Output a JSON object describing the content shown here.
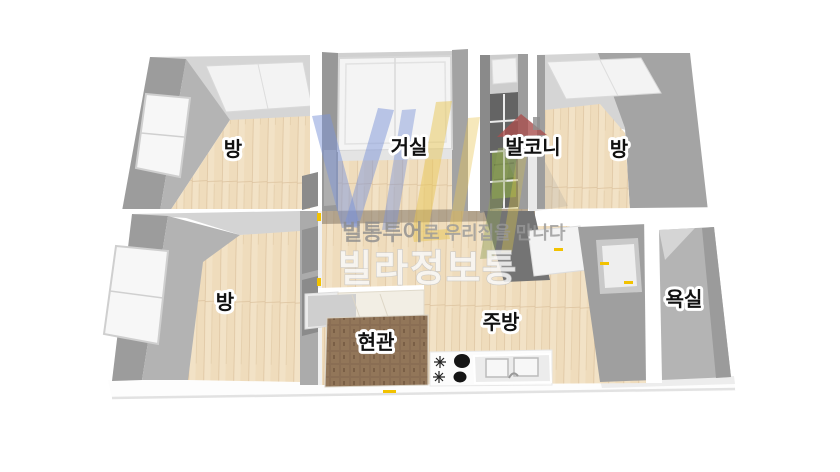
{
  "floorplan": {
    "background_color": "#ffffff",
    "rooms": [
      {
        "id": "bedroom-top-left",
        "label": "방"
      },
      {
        "id": "living-room",
        "label": "거실"
      },
      {
        "id": "balcony",
        "label": "발코니"
      },
      {
        "id": "bedroom-top-right",
        "label": "방"
      },
      {
        "id": "bedroom-bottom-left",
        "label": "방"
      },
      {
        "id": "entrance",
        "label": "현관"
      },
      {
        "id": "kitchen",
        "label": "주방"
      },
      {
        "id": "bathroom",
        "label": "욕실"
      }
    ],
    "colors": {
      "floor_wood": "#efdcbc",
      "floor_wood_line": "#dcc29e",
      "wall_dark": "#9c9c9c",
      "wall_mid": "#b4b4b4",
      "wall_light": "#d5d5d5",
      "ceiling_white": "#f3f3f3",
      "entrance_tile": "#8a6e54",
      "balcony_floor": "#646464",
      "balcony_green": "#7e9153",
      "accent_yellow": "#f2c200",
      "label_text": "#111111",
      "label_outline": "#ffffff"
    },
    "kitchen_fixtures": {
      "burner_count": 2,
      "burner_color": "#151515",
      "icons": [
        "stove-burner-icon",
        "burner-knob-icon",
        "sink-icon"
      ]
    }
  },
  "watermark": {
    "logo_letters": "VILLA",
    "letter_color_blue": "#7b93d8",
    "letter_color_yellow": "#e8c554",
    "letter_color_green": "#8fa05a",
    "house_roof_color": "#a94f4d",
    "tagline_brand": "빌통투어",
    "tagline_rest": "로 우리집을 만나다",
    "brand": "빌라정보통"
  }
}
